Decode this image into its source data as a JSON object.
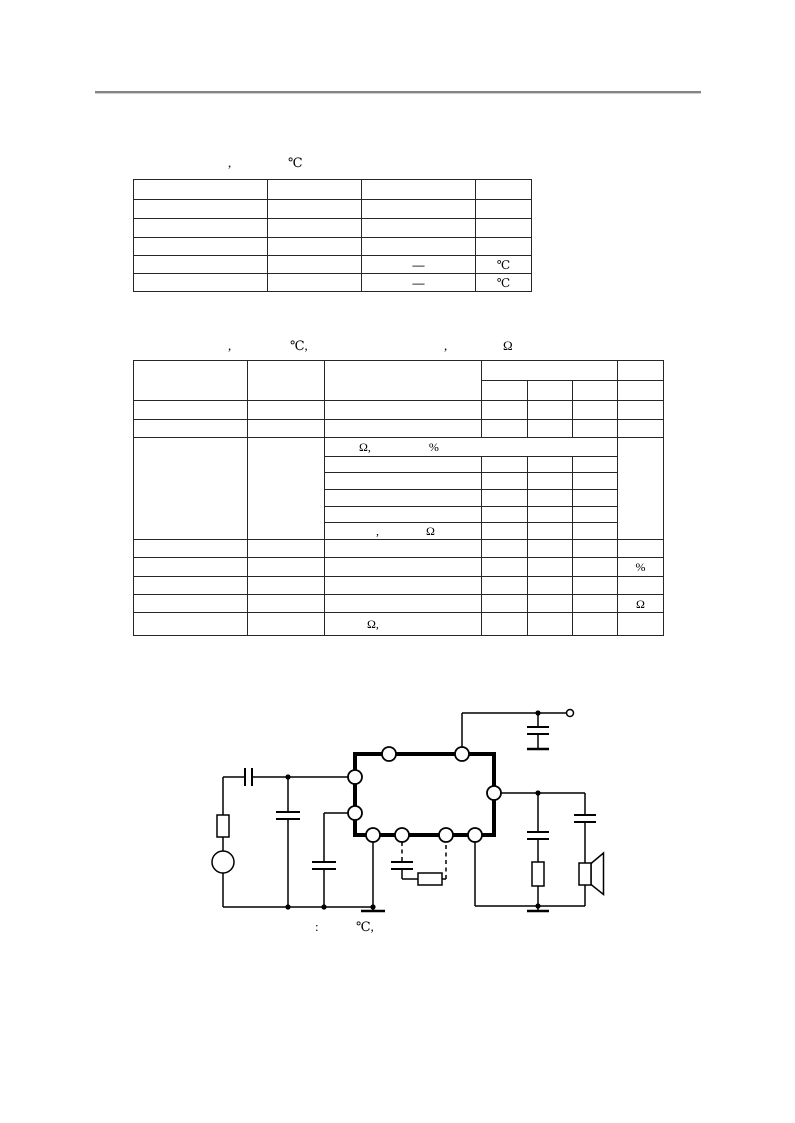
{
  "page": {
    "background": "#ffffff",
    "ink": "#000000",
    "rule_color": "#848484"
  },
  "table1": {
    "caption_parts": [
      ",",
      "℃"
    ],
    "cells": {
      "r5_c3": "—",
      "r5_c4": "℃",
      "r6_c3": "—",
      "r6_c4": "℃"
    }
  },
  "table2": {
    "caption_parts": [
      ",",
      "℃,",
      ",",
      "Ω"
    ],
    "cells": {
      "sr1_a": "Ω,",
      "sr1_b": "%",
      "sr6_a": ",",
      "sr6_b": "Ω",
      "r4_unit": "%",
      "r6_unit": "Ω",
      "r7_c3": "Ω,"
    }
  },
  "circuit": {
    "caption_parts": [
      ":",
      "℃,"
    ]
  }
}
